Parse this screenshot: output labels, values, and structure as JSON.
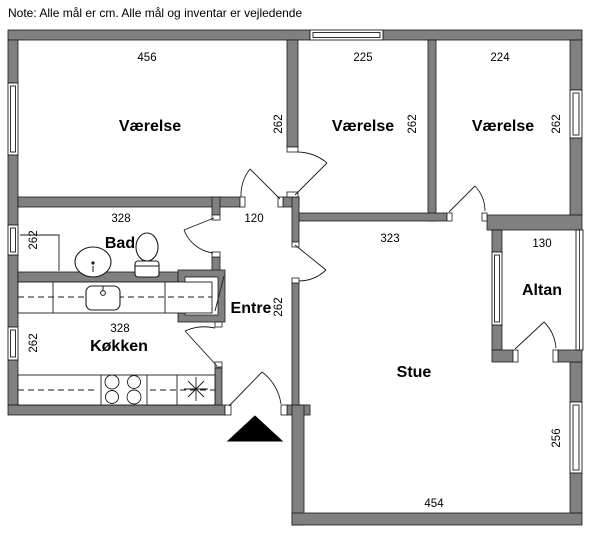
{
  "note": "Note: Alle mål er cm. Alle mål og inventar er vejledende",
  "colors": {
    "wall": "#808080",
    "outline": "#1a1a1a",
    "floor": "#ffffff"
  },
  "rooms": {
    "vaerelse1": {
      "label": "Værelse",
      "width": "456",
      "depth": "262"
    },
    "vaerelse2": {
      "label": "Værelse",
      "width": "225",
      "depth": "262"
    },
    "vaerelse3": {
      "label": "Værelse",
      "width": "224",
      "depth": "262"
    },
    "bad": {
      "label": "Bad",
      "width": "328",
      "depth": "262"
    },
    "koekken": {
      "label": "Køkken",
      "width": "328",
      "depth": "262"
    },
    "entre": {
      "label": "Entre",
      "hall_width": "120",
      "depth": "262"
    },
    "stue": {
      "label": "Stue",
      "top_width": "323",
      "bottom_width": "454",
      "depth": "256"
    },
    "altan": {
      "label": "Altan",
      "width": "130"
    }
  }
}
